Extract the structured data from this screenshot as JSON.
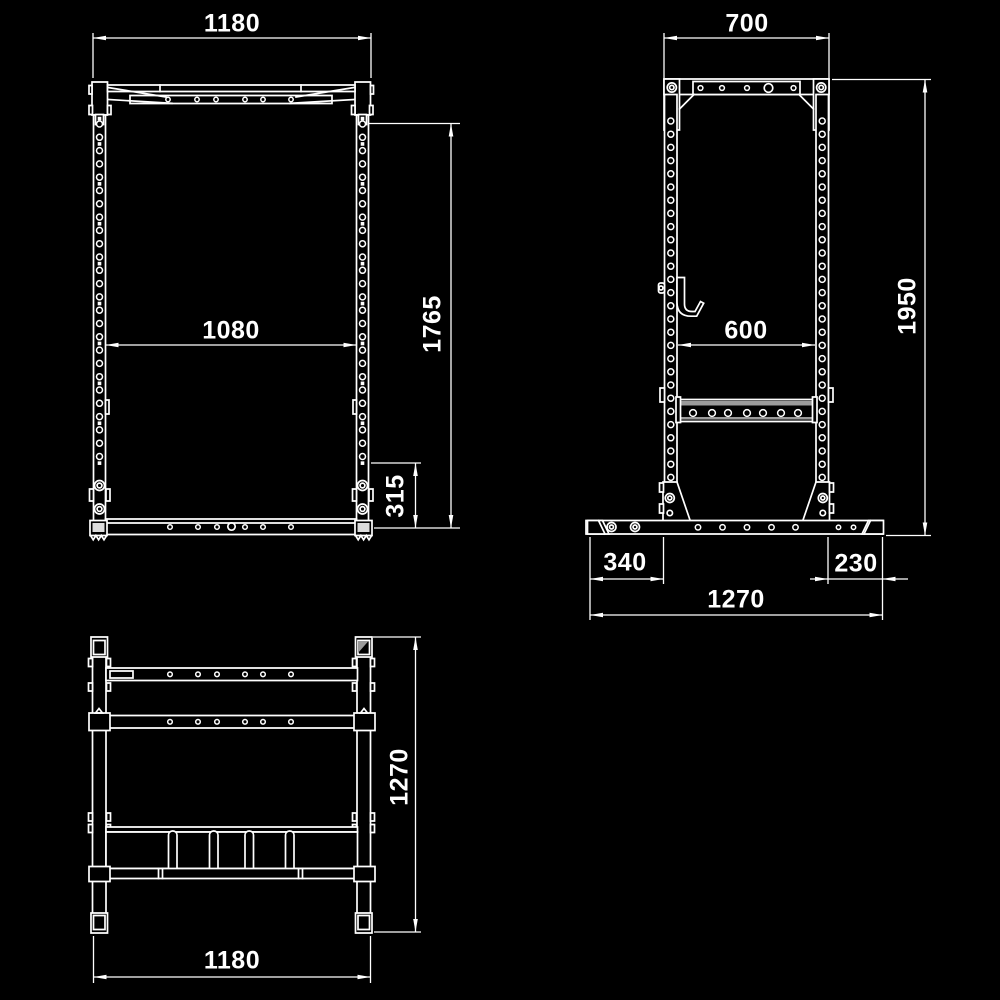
{
  "colors": {
    "background": "#000000",
    "line": "#ffffff",
    "accent_gray": "#9a9a9a"
  },
  "views": {
    "front": {
      "dims": {
        "overall_width": "1180",
        "inner_width": "1080",
        "overall_height": "1765",
        "base_height": "315"
      }
    },
    "side": {
      "dims": {
        "top_width": "700",
        "inner_depth": "600",
        "overall_height": "1950",
        "front_foot_offset": "340",
        "rear_foot_offset": "230",
        "base_depth": "1270"
      }
    },
    "top": {
      "dims": {
        "depth": "1270",
        "width": "1180"
      }
    }
  }
}
